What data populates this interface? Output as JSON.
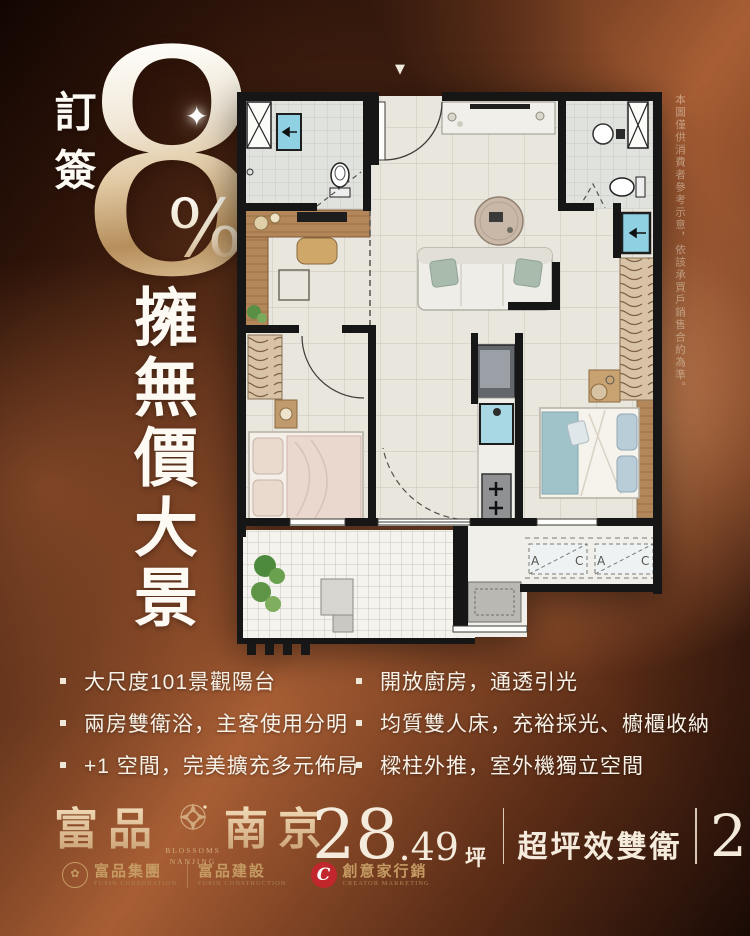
{
  "promo": {
    "prefix_vertical": "訂簽",
    "big_number": "8",
    "percent_sign": "%",
    "sparkle": "✦",
    "headline_vertical": "擁無價大景"
  },
  "marker": "▼",
  "disclaimer": "本圖僅供消費者參考示意，依該承買戶銷售合約為準。",
  "floorplan": {
    "ac_unit_labels": [
      "A",
      "C",
      "A",
      "C"
    ]
  },
  "features": {
    "left": [
      "大尺度101景觀陽台",
      "兩房雙衛浴，主客使用分明",
      "+1 空間，完美擴充多元佈局"
    ],
    "right": [
      "開放廚房，通透引光",
      "均質雙人床，充裕採光、櫥櫃收納",
      "樑柱外推，室外機獨立空間"
    ]
  },
  "footer": {
    "brand_cn_left": "富品",
    "brand_cn_right": "南京",
    "brand_en_top": "BLOSSOMS",
    "brand_en_bottom": "NANJING",
    "companies": [
      {
        "name": "富品集團",
        "en": "FUPIN CORPORATION"
      },
      {
        "name": "富品建設",
        "en": "FUPIN CONSTRUCTION"
      },
      {
        "name": "創意家行銷",
        "en": "CREATOR MARKETING",
        "monogram": "C"
      }
    ],
    "stats": {
      "area_int": "28",
      "area_dec": ".49",
      "area_unit": "坪",
      "tagline": "超坪效雙衛",
      "layout_num": "2+1",
      "layout_unit": "房"
    }
  },
  "colors": {
    "brand_gold": "#d2b48c",
    "logo_red": "#c1272d",
    "background_copper": "#a85e34",
    "text_white": "#f5efe6"
  }
}
